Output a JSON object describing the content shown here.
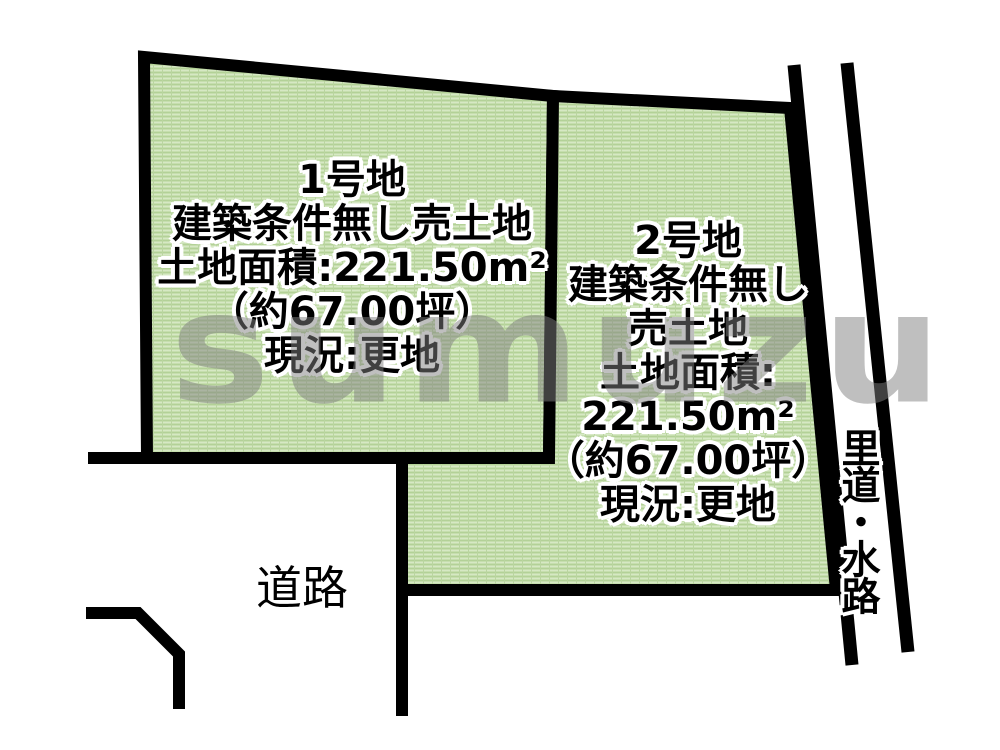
{
  "labels": {
    "road": "道路",
    "waterway": "里道・水路"
  },
  "watermark": {
    "text": "sumuzu"
  },
  "plots": [
    {
      "name": "1号地",
      "lines": [
        "1号地",
        "建築条件無し売土地",
        "土地面積:221.50m²",
        "（約67.00坪）",
        "現況:更地"
      ]
    },
    {
      "name": "2号地",
      "lines": [
        "2号地",
        "建築条件無し",
        "売土地",
        "土地面積:",
        "221.50m²",
        "（約67.00坪）",
        "現況:更地"
      ]
    }
  ],
  "colors": {
    "plot_fill": "#c6deae",
    "plot_texture_dark": "#b3d197",
    "plot_texture_light": "#d6e8c4",
    "boundary_line": "#000000",
    "watermark_gray": "#7f7f7f"
  }
}
